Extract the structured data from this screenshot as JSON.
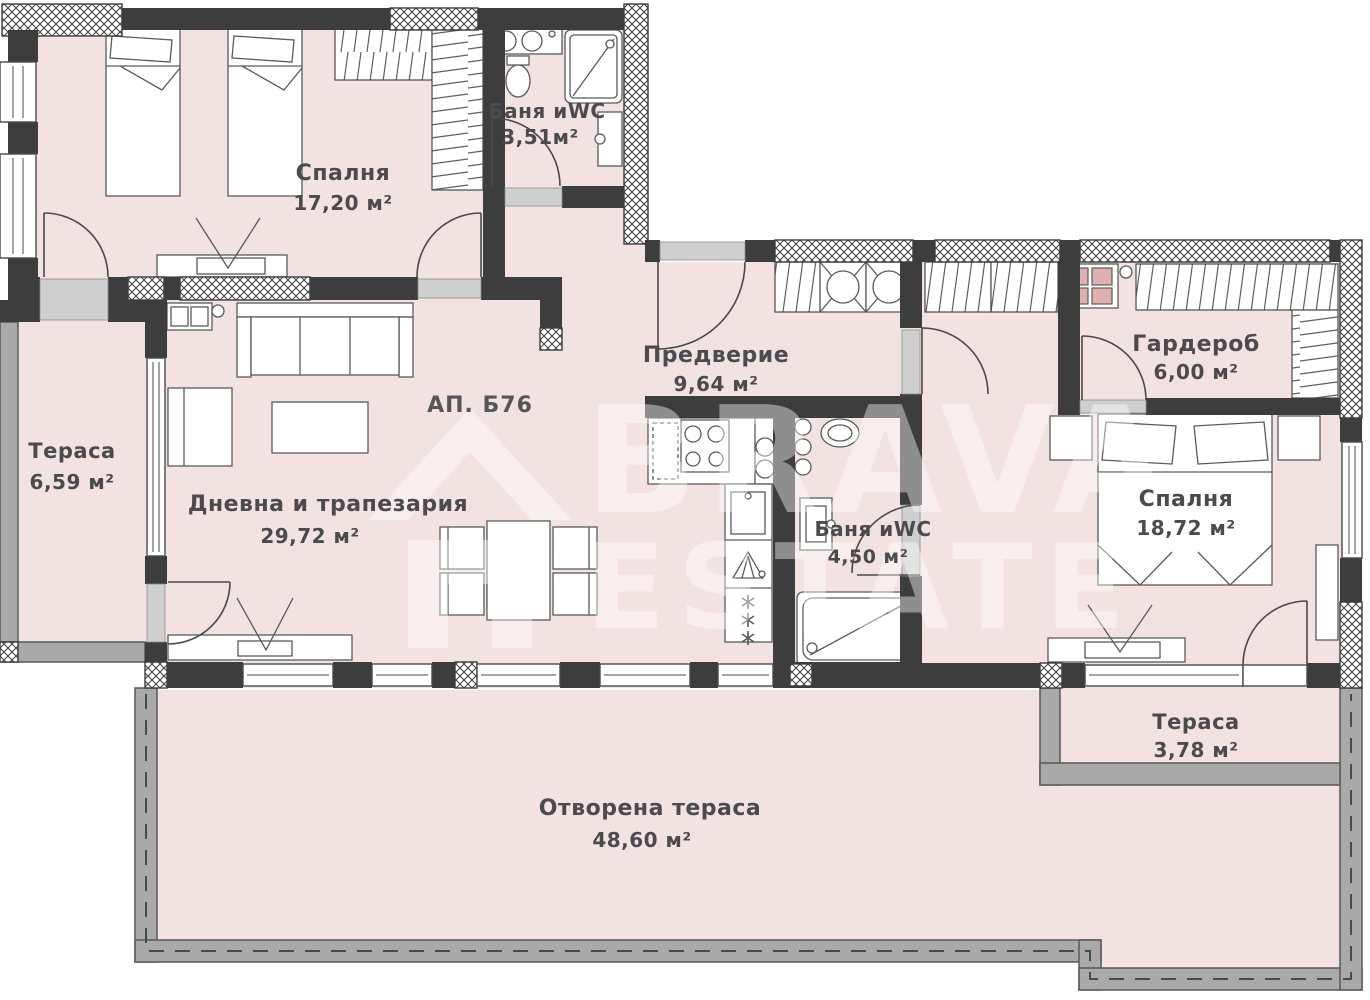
{
  "plan": {
    "apartment_label": "АП. Б76",
    "watermark": {
      "brand_top": "BRAVA",
      "brand_bottom": "ESTATE"
    },
    "rooms": {
      "bedroom1": {
        "name": "Спалня",
        "area": "17,20 м²"
      },
      "bath1": {
        "name": "Баня иWC",
        "area": "3,51м²"
      },
      "hallway": {
        "name": "Предверие",
        "area": "9,64 м²"
      },
      "wardrobe": {
        "name": "Гардероб",
        "area": "6,00 м²"
      },
      "terrace_left": {
        "name": "Тераса",
        "area": "6,59 м²"
      },
      "living": {
        "name": "Дневна и трапезария",
        "area": "29,72 м²"
      },
      "bath2": {
        "name": "Баня иWC",
        "area": "4,50 м²"
      },
      "bedroom2": {
        "name": "Спалня",
        "area": "18,72 м²"
      },
      "terrace_right": {
        "name": "Тераса",
        "area": "3,78 м²"
      },
      "open_terrace": {
        "name": "Отворена тераса",
        "area": "48,60 м²"
      }
    },
    "colors": {
      "wall": "#3d3d3d",
      "room_fill": "#f3e2e2",
      "parapet": "#a9a9a9",
      "label_text": "#4a4a4f",
      "watermark": "#ffffff"
    }
  }
}
